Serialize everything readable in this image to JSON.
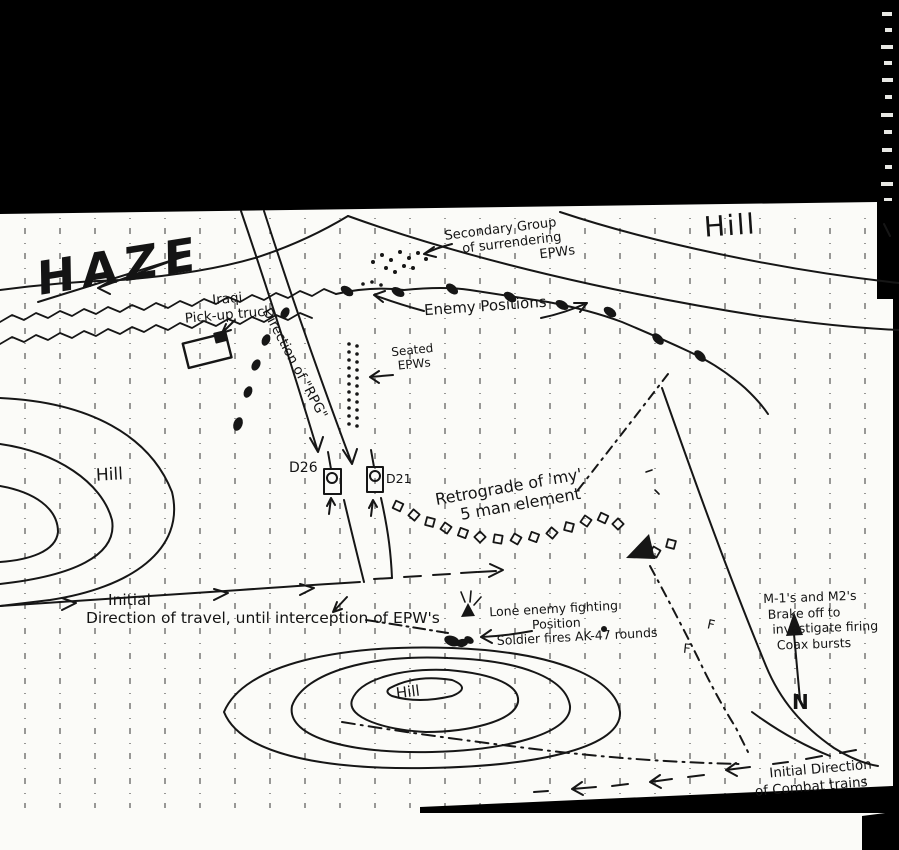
{
  "page": {
    "background_color": "#000000",
    "paper_color": "#fbfbf8",
    "ink_color": "#161616"
  },
  "labels": {
    "haze": "HAZE",
    "hill_north": "Hill",
    "hill_west": "Hill",
    "hill_south": "Hill",
    "iraqi_truck": [
      "Iraqi",
      "Pick-up truck"
    ],
    "rpg_direction": "Direction of \"RPG\"",
    "secondary_group": [
      "Secondary Group",
      "of surrendering",
      "EPWs"
    ],
    "enemy_positions": "Enemy Positions",
    "seated_epws": [
      "Seated",
      "EPWs"
    ],
    "tank_left": "D26",
    "tank_right": "D21",
    "retrograde": [
      "Retrograde of 'my'",
      "5 man element"
    ],
    "initial_travel": [
      "Initial",
      "Direction of travel, until interception of EPW's"
    ],
    "lone_enemy": [
      "Lone enemy fighting",
      "Position",
      "Soldier fires AK-47 rounds"
    ],
    "armor_breakoff": [
      "M-1's and M2's",
      "Brake off to",
      "investigate firing",
      "Coax bursts"
    ],
    "north": "N",
    "combat_trains": [
      "Initial Direction",
      "of Combat trains"
    ],
    "route_mark_1": "F",
    "route_mark_2": "F"
  }
}
